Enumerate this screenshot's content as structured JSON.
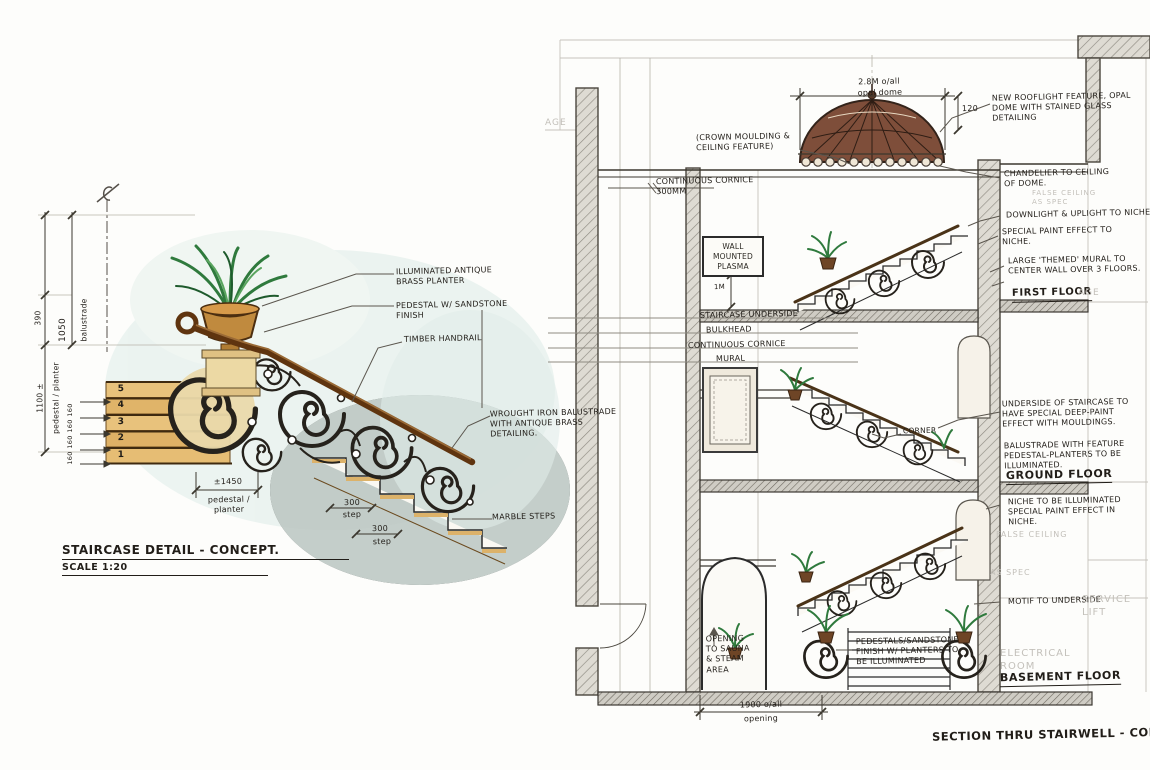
{
  "left": {
    "title": "STAIRCASE DETAIL - CONCEPT.",
    "scale": "SCALE 1:20",
    "notes": {
      "planter": "ILLUMINATED ANTIQUE BRASS PLANTER",
      "pedestal": "PEDESTAL W/ SANDSTONE FINISH",
      "handrail": "TIMBER HANDRAIL",
      "balustrade": "WROUGHT IRON BALUSTRADE WITH ANTIQUE BRASS DETAILING.",
      "marble": "MARBLE STEPS"
    },
    "dims": {
      "balustrade_height": "1050",
      "balustrade_word": "balustrade",
      "upper": "390",
      "pedestal_height": "1100 ±",
      "pedestal_height_word": "pedestal / planter",
      "riser": "160",
      "pedestal_width": "±1450",
      "pedestal_width_word": "pedestal / planter",
      "going": "300",
      "going_word": "step",
      "steps": [
        "5",
        "4",
        "3",
        "2",
        "1"
      ]
    }
  },
  "right": {
    "title": "SECTION THRU STAIRWELL - CONCEPT",
    "floors": {
      "first": "FIRST FLOOR",
      "ground": "GROUND FLOOR",
      "basement": "BASEMENT FLOOR"
    },
    "dims": {
      "dome": "2.8M o/all",
      "dome_word": "opal dome",
      "dome_rise": "120",
      "opening": "1900 o/all",
      "opening_word": "opening",
      "plasma_height": "1M"
    },
    "notes": {
      "rooflight": "NEW ROOFLIGHT FEATURE, OPAL DOME WITH STAINED GLASS DETAILING",
      "chandelier": "CHANDELIER TO CEILING OF DOME.",
      "downlight": "DOWNLIGHT & UPLIGHT TO NICHE.",
      "paint_niche": "SPECIAL PAINT EFFECT TO NICHE.",
      "mural_wall": "LARGE 'THEMED' MURAL TO CENTER WALL OVER 3 FLOORS.",
      "crown": "(CROWN MOULDING & CEILING FEATURE)",
      "cornice_300": "CONTINUOUS CORNICE 300MM",
      "plasma": "WALL MOUNTED PLASMA",
      "staircase_underside": "STAIRCASE UNDERSIDE",
      "bulkhead": "BULKHEAD",
      "cont_cornice": "CONTINUOUS CORNICE",
      "mural": "MURAL",
      "underside_paint": "UNDERSIDE OF STAIRCASE TO HAVE SPECIAL DEEP-PAINT EFFECT WITH MOULDINGS.",
      "balustrade_feature": "BALUSTRADE WITH FEATURE PEDESTAL-PLANTERS TO BE ILLUMINATED.",
      "corner": "CORNER",
      "niche_illum": "NICHE TO BE ILLUMINATED SPECIAL PAINT EFFECT IN NICHE.",
      "motif": "MOTIF TO UNDERSIDE",
      "sauna": "OPENING TO SAUNA & STEAM AREA",
      "pedestal_planters": "PEDESTALS/SANDSTONE FINISH W/ PLANTERS TO BE ILLUMINATED"
    },
    "cad": {
      "left_fragment": "AGE",
      "first_fragment": "AGE",
      "false_ceiling_1": "FALSE CEILING AS SPEC",
      "false_ceiling_2": "FALSE CEILING",
      "as_spec": "AS SPEC",
      "service_lift": "SERVICE LIFT",
      "electrical": "ELECTRICAL ROOM"
    }
  },
  "colors": {
    "ink": "#2d2a24",
    "cad_gray": "#c3c0ba",
    "sandstone": "#e6c281",
    "brass": "#c08a3e",
    "timber": "#5f340f",
    "foliage": "#2f7a3d",
    "wash": "#e3efe9",
    "dome": "#7e4e3a"
  }
}
